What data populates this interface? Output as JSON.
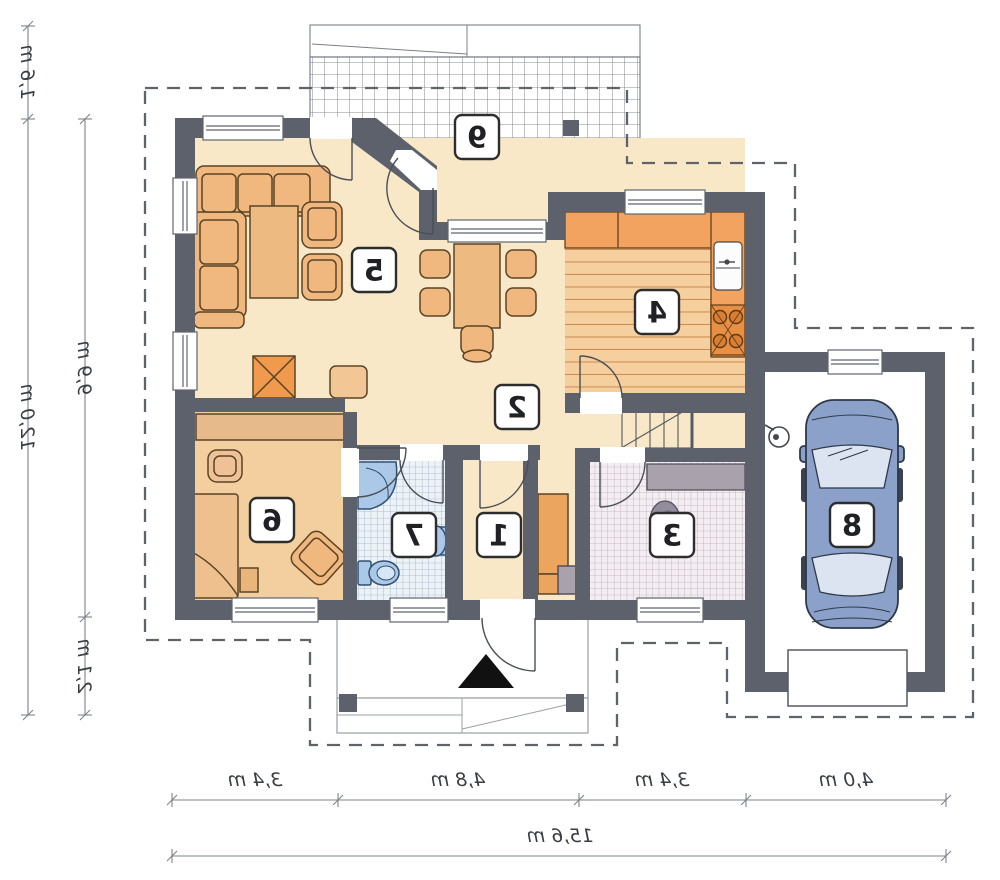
{
  "plan_title": "floor-plan",
  "rooms": [
    {
      "number": "1"
    },
    {
      "number": "2"
    },
    {
      "number": "3"
    },
    {
      "number": "4"
    },
    {
      "number": "5"
    },
    {
      "number": "6"
    },
    {
      "number": "7"
    },
    {
      "number": "8"
    },
    {
      "number": "9"
    }
  ],
  "dimensions": {
    "left_outer": [
      {
        "label": "1,6 m"
      },
      {
        "label": "12,0 m"
      }
    ],
    "left_inner": [
      {
        "label": "9,9 m"
      },
      {
        "label": "2,1 m"
      }
    ],
    "bottom_segments": [
      {
        "label": "3,4 m"
      },
      {
        "label": "4,8 m"
      },
      {
        "label": "3,4 m"
      },
      {
        "label": "4,0 m"
      }
    ],
    "bottom_total": {
      "label": "15,6 m"
    }
  },
  "colors": {
    "wall": "#5c616c",
    "floor_main": "#f8e8c8",
    "floor_room6": "#f3cf9f",
    "floor_kitchen": "#f6cf9e",
    "furniture": "#f0b87e",
    "counter_orange": "#f1a35f",
    "fixture_blue": "#abc8e8",
    "car_blue": "#8ba1c9",
    "tile_bath_line": "#9db2ca",
    "tile_utility_line": "#b9abb9",
    "counter_gray": "#a9a2ac"
  }
}
